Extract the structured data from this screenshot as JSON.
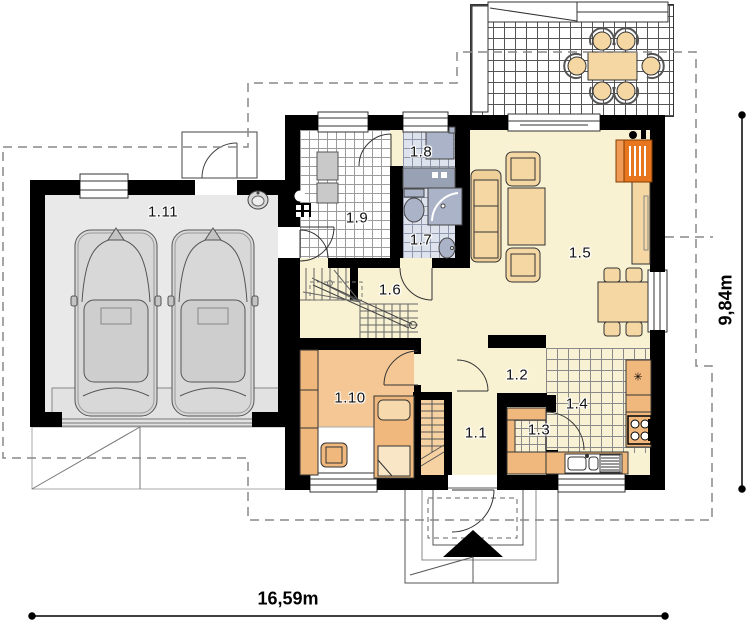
{
  "plan": {
    "room_labels": [
      "1.1",
      "1.2",
      "1.3",
      "1.4",
      "1.5",
      "1.6",
      "1.7",
      "1.8",
      "1.9",
      "1.10",
      "1.11"
    ],
    "dimensions": {
      "horizontal": "16,59m",
      "vertical": "9,84m"
    },
    "symbols": {
      "fridge": "✳"
    },
    "colors": {
      "wall": "#000000",
      "floor_cream": "#f9f2d2",
      "floor_bedroom": "#f4c795",
      "floor_garage": "#e9e9e9",
      "bath_tile": "#dde2ec",
      "furniture_tan": "#f5d7a4",
      "furniture_orange": "#f1b87e",
      "fireplace_orange": "#e8761e",
      "fixture_gray_blue": "#aab3c8"
    }
  }
}
